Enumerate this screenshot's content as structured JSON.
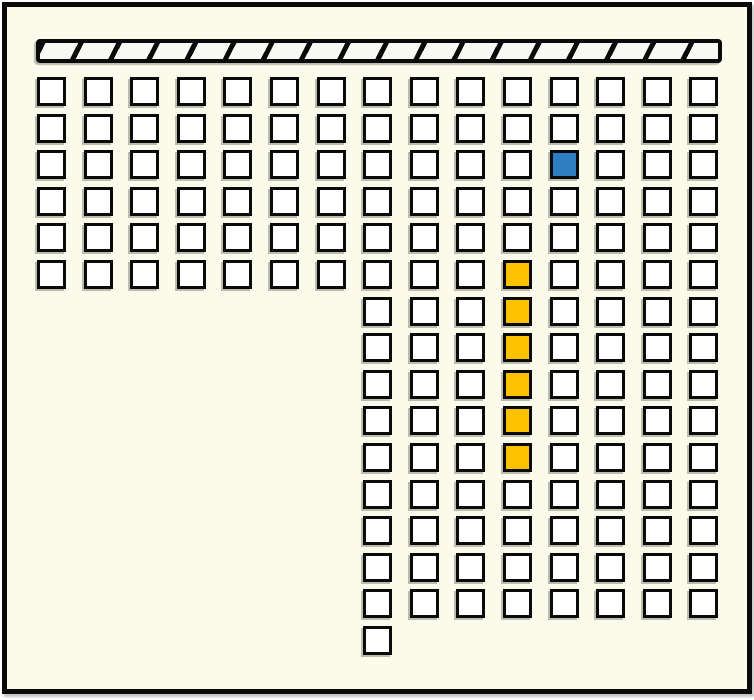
{
  "window": {
    "width": 754,
    "height": 700,
    "background": "#FBFBEC",
    "frame_border_color": "#0A0A0A"
  },
  "stage_bar": {
    "description": "diagonally-hatched horizontal bar at top (stage/wall)",
    "x": 36,
    "y": 39,
    "width": 686,
    "height": 24,
    "fill": "#F9F9F4",
    "hatch_color": "#0A0A0A",
    "hatch_angle_deg": 117,
    "hatch_spacing": 34,
    "hatch_thickness": 5
  },
  "seat_grid": {
    "origin_x": 37,
    "origin_y": 77,
    "col_pitch": 46.6,
    "row_pitch": 36.6,
    "cell_size": 29,
    "cell_fill": "#FFFFFF",
    "cell_border": "#0A0A0A",
    "columns": 15,
    "rows": 16,
    "sections": [
      {
        "name": "upper-full-block",
        "row_start": 1,
        "row_end": 6,
        "col_start": 1,
        "col_end": 15
      },
      {
        "name": "lower-right-block",
        "row_start": 7,
        "row_end": 15,
        "col_start": 8,
        "col_end": 15
      },
      {
        "name": "bottom-single",
        "row_start": 16,
        "row_end": 16,
        "col_start": 8,
        "col_end": 8
      }
    ],
    "highlighted_cells": [
      {
        "row": 3,
        "col": 12,
        "color": "#2E7FC1",
        "name": "blue-highlighted-cell"
      },
      {
        "row": 6,
        "col": 11,
        "color": "#FCC200",
        "name": "yellow-highlighted-cell"
      },
      {
        "row": 7,
        "col": 11,
        "color": "#FCC200",
        "name": "yellow-highlighted-cell"
      },
      {
        "row": 8,
        "col": 11,
        "color": "#FCC200",
        "name": "yellow-highlighted-cell"
      },
      {
        "row": 9,
        "col": 11,
        "color": "#FCC200",
        "name": "yellow-highlighted-cell"
      },
      {
        "row": 10,
        "col": 11,
        "color": "#FCC200",
        "name": "yellow-highlighted-cell"
      },
      {
        "row": 11,
        "col": 11,
        "color": "#FCC200",
        "name": "yellow-highlighted-cell"
      }
    ],
    "counts": {
      "total_cells": 163,
      "blue_cells": 1,
      "yellow_cells": 6,
      "white_cells": 156
    }
  }
}
